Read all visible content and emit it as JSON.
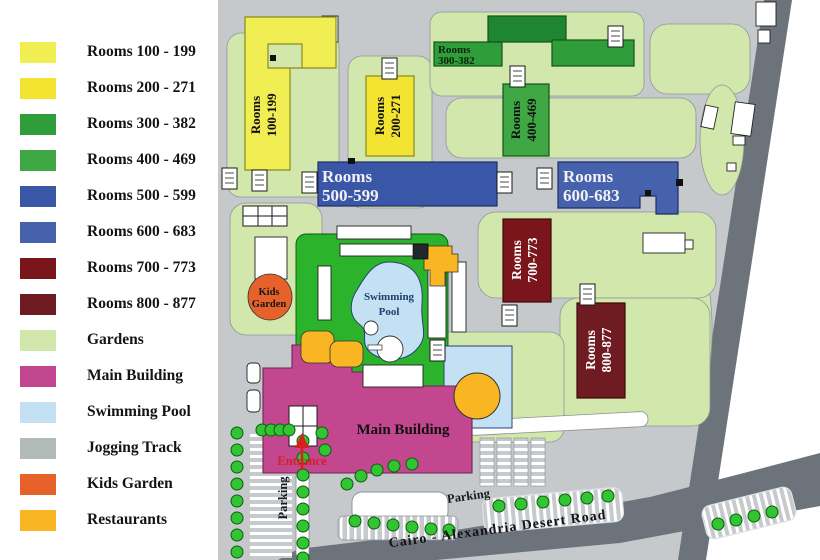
{
  "legend": {
    "items": [
      {
        "label": "Rooms 100 - 199",
        "color": "#F0EE52"
      },
      {
        "label": "Rooms 200 - 271",
        "color": "#F2E430"
      },
      {
        "label": "Rooms 300 - 382",
        "color": "#2F9E3A"
      },
      {
        "label": "Rooms 400 - 469",
        "color": "#3FA845"
      },
      {
        "label": "Rooms 500 - 599",
        "color": "#3A56A6"
      },
      {
        "label": "Rooms 600 - 683",
        "color": "#4762AC"
      },
      {
        "label": "Rooms 700 - 773",
        "color": "#7A151B"
      },
      {
        "label": "Rooms 800 - 877",
        "color": "#6E1B21"
      },
      {
        "label": "Gardens",
        "color": "#D2E7AC"
      },
      {
        "label": "Main Building",
        "color": "#C2478E"
      },
      {
        "label": "Swimming Pool",
        "color": "#C3E1F2"
      },
      {
        "label": "Jogging Track",
        "color": "#B1B9B9"
      },
      {
        "label": "Kids Garden",
        "color": "#E7622B"
      },
      {
        "label": "Restaurants",
        "color": "#F9B622"
      }
    ]
  },
  "map": {
    "buildings": {
      "r100": {
        "line1": "Rooms",
        "line2": "100-199"
      },
      "r200": {
        "line1": "Rooms",
        "line2": "200-271"
      },
      "r300": {
        "line1": "Rooms",
        "line2": "300-382"
      },
      "r400": {
        "line1": "Rooms",
        "line2": "400-469"
      },
      "r500": {
        "line1": "Rooms",
        "line2": "500-599"
      },
      "r600": {
        "line1": "Rooms",
        "line2": "600-683"
      },
      "r700": {
        "line1": "Rooms",
        "line2": "700-773"
      },
      "r800": {
        "line1": "Rooms",
        "line2": "800-877"
      }
    },
    "labels": {
      "kids_line1": "Kids",
      "kids_line2": "Garden",
      "pool_line1": "Swimming",
      "pool_line2": "Pool",
      "main_building": "Main Building",
      "entrance": "Entrance",
      "parking_left": "Parking",
      "parking_bottom": "Parking",
      "road_name": "Cairo - Alexandria Desert Road"
    },
    "colors": {
      "deck_green": "#2BB32B",
      "road_gray": "#C5C9CB",
      "road_dark": "#6D737A",
      "green_dark": "#1E8530",
      "tree_green": "#33C433"
    }
  }
}
